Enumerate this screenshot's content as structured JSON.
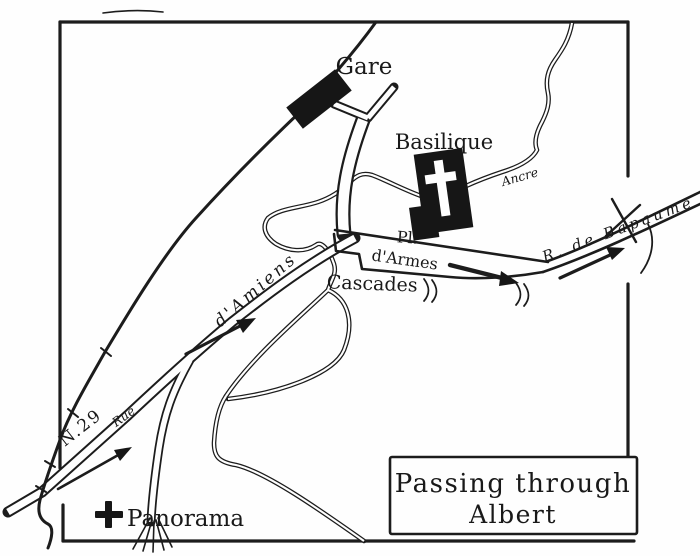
{
  "map": {
    "name": "Hand-drawn tourist sketch map of Albert, France",
    "colors": {
      "ink": "#1c1c1c",
      "paper": "#fefefe",
      "building_fill": "#161616"
    },
    "labels": {
      "gare": "Gare",
      "basilique": "Basilique",
      "ancre": "Ancre",
      "place_line1": "Pl.",
      "place_line2": "d'Armes",
      "bapaume": "R. de Bapaume",
      "cascades": "Cascades",
      "amiens": "d'Amiens",
      "rue": "Rue",
      "n29": "N.29",
      "panorama": "Panorama"
    },
    "title_box": {
      "line1": "Passing through",
      "line2": "Albert"
    }
  }
}
